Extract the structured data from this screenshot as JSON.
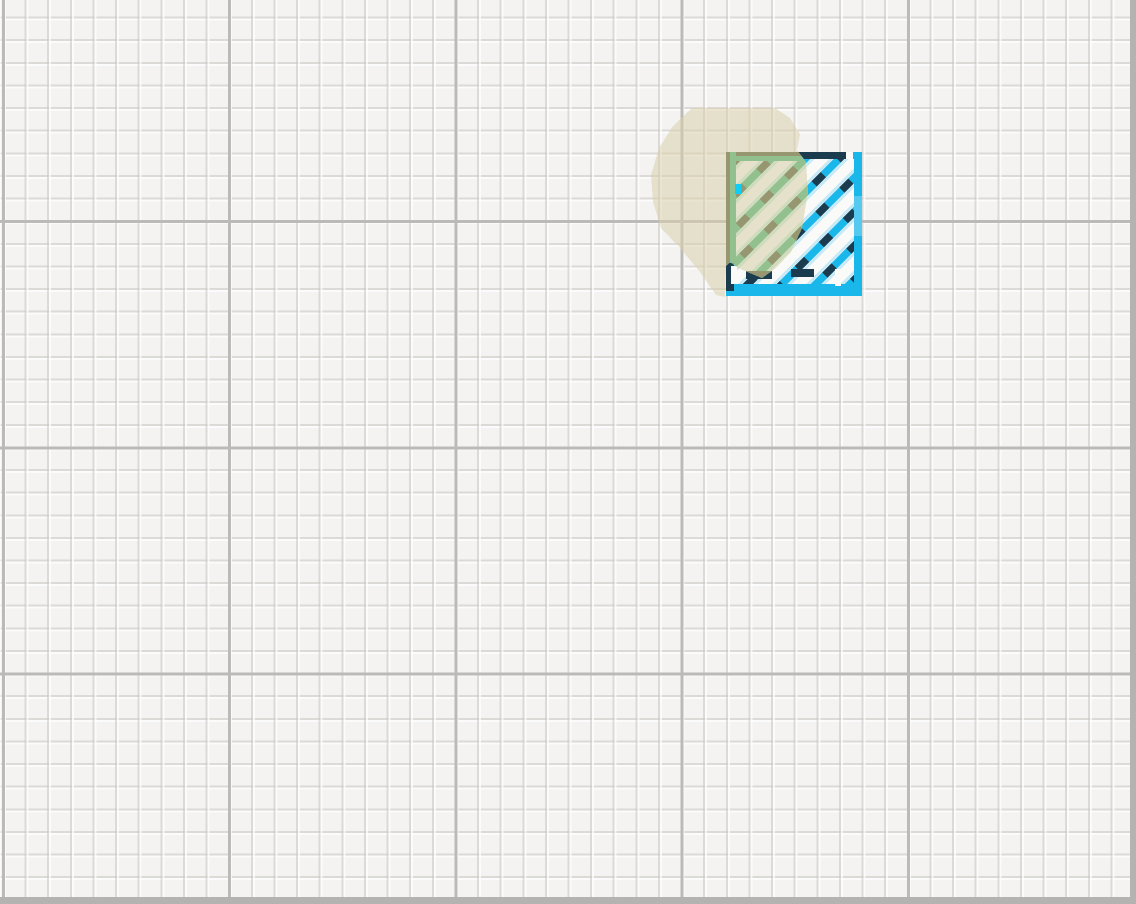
{
  "scene": {
    "canvas": {
      "width": 1136,
      "height": 904,
      "paper_color": "#f4f3f1"
    },
    "grid": {
      "minor_step_px": 22.62,
      "major_step_px": 226.2,
      "minor_color": "rgba(196,193,189,0.5)",
      "minor_highlight": "rgba(255,255,255,0.7)",
      "major_color": "#bcbab7",
      "phase_x_px": 2,
      "phase_y_px": -6,
      "edge_color": "#b4b3b1"
    },
    "blob": {
      "label": "highlighter-blob",
      "fill": "#d8cfab",
      "opacity": 0.55,
      "points": "692,108 775,108 790,118 800,134 797,150 806,162 808,192 802,228 791,252 776,268 762,278 738,268 730,262 726,266 725,297 716,295 700,272 680,248 661,228 653,202 651,175 659,148 673,126"
    },
    "square": {
      "label": "hatched-square-sticker",
      "x": 726,
      "y": 152,
      "width": 136,
      "height": 144,
      "border_top": 7,
      "border_side": 8,
      "border_bottom": 12,
      "palette_base": {
        "stroke": "#1ab7ea",
        "stroke_light": "#55c9ef",
        "accent": "#1a3c4e",
        "halo": "#c8eaf6",
        "fill": "#fafaf8"
      },
      "palette_tinted": {
        "stroke": "#3fae6e",
        "stroke_light": "#52ba7c",
        "accent": "#46502a",
        "halo": "#c0ecd2",
        "fill": "#f7f5ef"
      },
      "hatch": {
        "angle_deg": 45,
        "spacing_px": 34,
        "stroke_width": 7.5,
        "halo_width": 14,
        "dash": "13 21",
        "count": 8,
        "first_offset": -122
      },
      "details": {
        "top_accent_bar": [
          798,
          152,
          48,
          7
        ],
        "top_white_gap": [
          846,
          152,
          7,
          7
        ],
        "left_accent_bar": [
          726,
          263,
          8,
          28
        ],
        "right_light_dash": [
          854,
          196,
          8,
          40
        ],
        "bottom_accent_dash_1": [
          746,
          271,
          26,
          8
        ],
        "bottom_accent_dash_2": [
          791,
          269,
          23,
          8
        ],
        "bottom_white_notch": [
          835,
          269,
          6,
          17
        ],
        "bottom_white_gap_col": [
          731,
          266,
          6,
          18
        ],
        "cyan_blip": [
          735,
          184,
          6,
          10
        ],
        "cyan_blip_color": "#10cdf5"
      }
    }
  }
}
